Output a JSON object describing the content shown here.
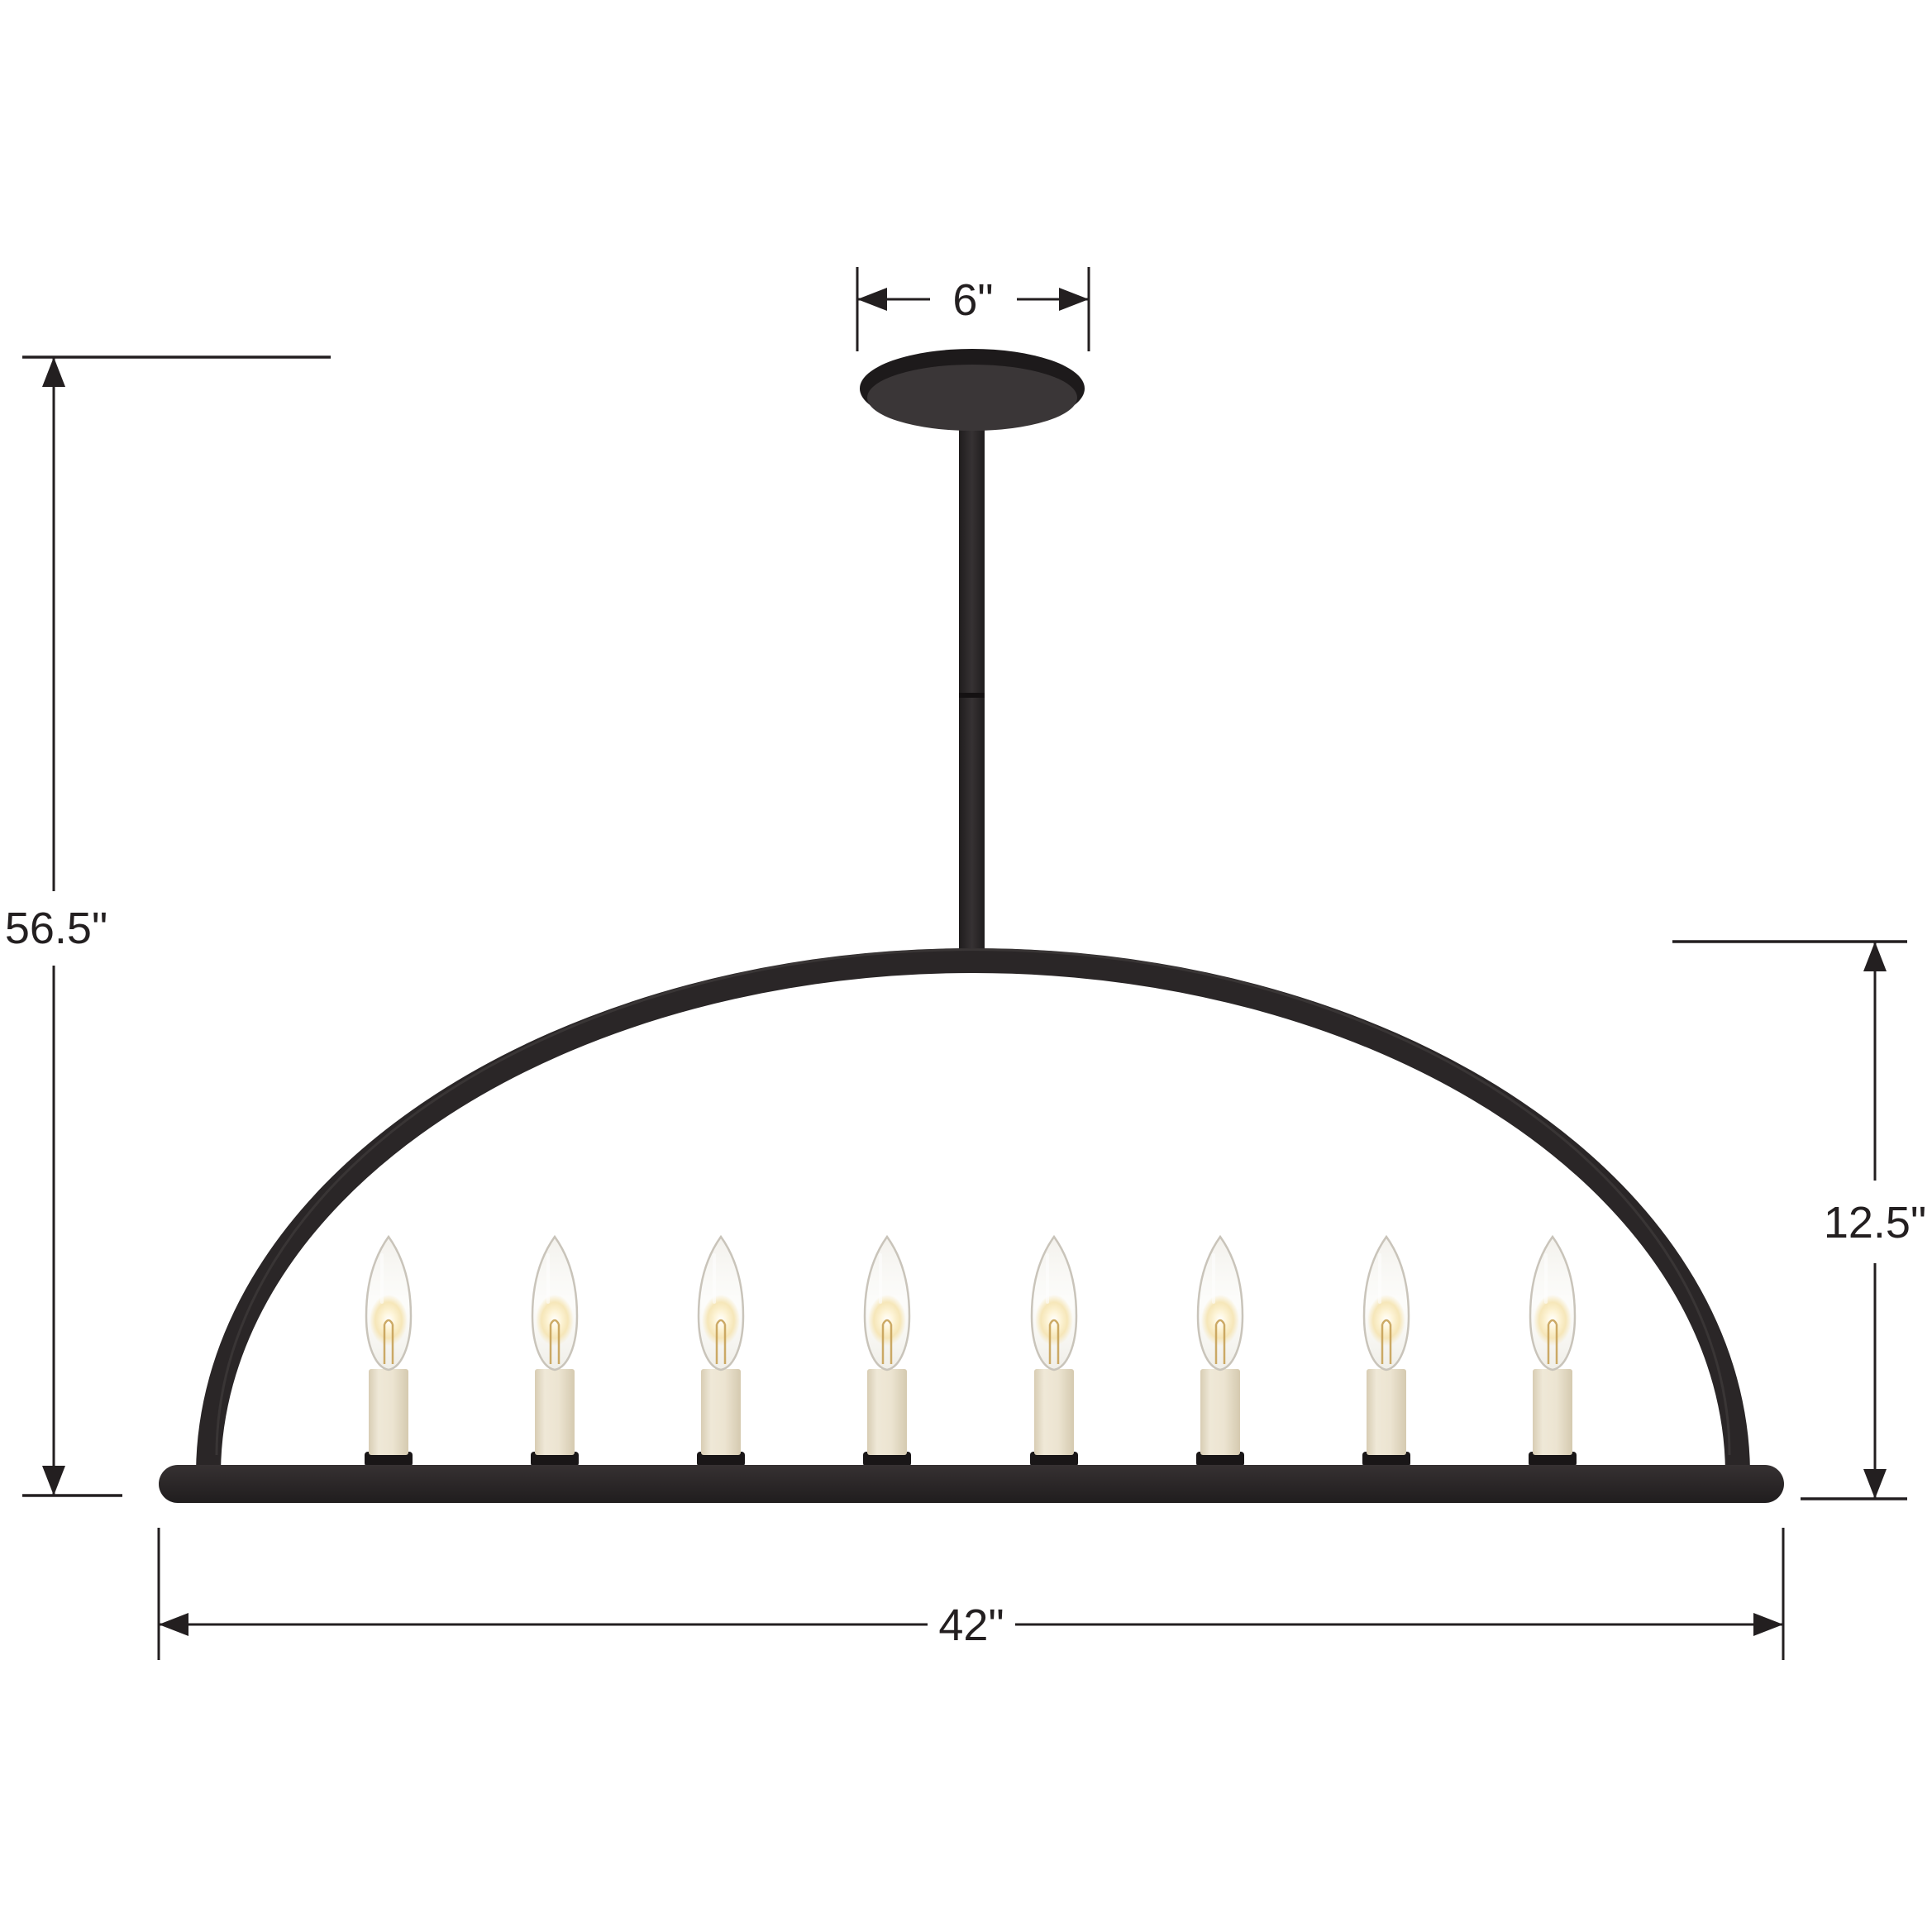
{
  "diagram": {
    "title": "arched linear chandelier dimension diagram",
    "fixture": {
      "light_count": 8,
      "style": "arch frame with candelabra lights"
    },
    "dimensions": {
      "canopy_width": "6\"",
      "overall_height": "56.5\"",
      "body_height": "12.5\"",
      "overall_width": "42\""
    },
    "colors": {
      "line": "#231f20",
      "fixture_black": "#2a2627",
      "fixture_black_deep": "#1d1a1b",
      "canopy_face": "#3a3637",
      "bar_fill": "#2b2728",
      "socket_black": "#191617",
      "candle_ivory": "#ece4d1",
      "candle_ivory_shade": "#d8cdb4",
      "bulb_glow_core": "#ffffff",
      "bulb_glow_warm": "#f5e3ae",
      "bulb_glass_edge": "#c9c4ba",
      "filament": "#c7a157",
      "background": "#ffffff"
    }
  }
}
